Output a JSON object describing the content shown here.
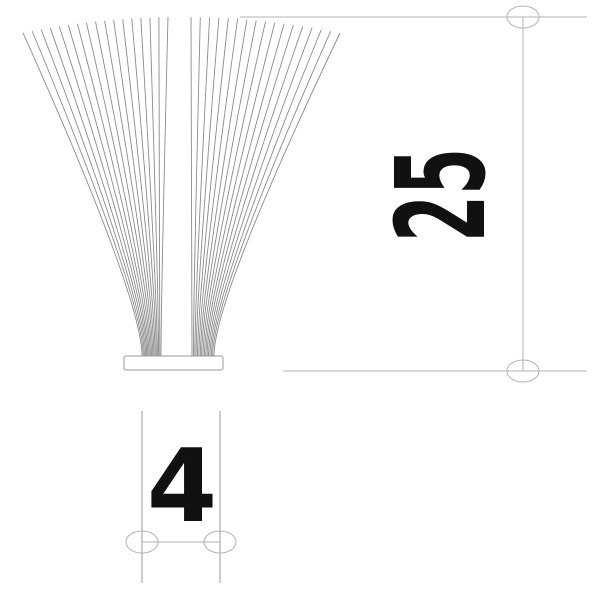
{
  "page": {
    "background": "#ffffff"
  },
  "drawing": {
    "type": "technical-drawing",
    "subject": "wire-brush-strip-profile",
    "text_color": "#111111",
    "wires": {
      "count_per_side": 17,
      "color": "#8a8a8a",
      "stroke_width": 0.9,
      "base_top_y": 356,
      "bend_y": 298,
      "tip_apex_y": 17,
      "tip_edge_y": 33,
      "apex_x": 181,
      "half_span": 159,
      "left": {
        "base_x_start": 142,
        "base_x_end": 161,
        "tip_x_start": 23,
        "tip_x_end": 168
      },
      "right": {
        "base_x_start": 192,
        "base_x_end": 214,
        "tip_x_start": 191,
        "tip_x_end": 340
      }
    },
    "base": {
      "x": 124,
      "y": 356,
      "width": 99,
      "height": 14,
      "stroke": "#999999",
      "fill": "#ffffff"
    },
    "dimensions": {
      "line_color": "#b3b3b3",
      "ext_line_color": "#9a9a9a",
      "marker_rx": 16,
      "marker_ry": 11,
      "height": {
        "label": "25",
        "line_x": 523,
        "top_y": 17,
        "bottom_y": 371,
        "ext_top_x1": 240,
        "ext_top_x2": 587,
        "ext_bottom_x1": 283,
        "ext_bottom_x2": 587,
        "text_x": 484,
        "text_y": 195,
        "font_size": 123,
        "condense": 0.55
      },
      "width": {
        "label": "4",
        "line_y": 542,
        "left_x": 142,
        "right_x": 220,
        "ext_y1": 411,
        "ext_y2": 583,
        "text_x": 182,
        "text_y": 521,
        "font_size": 101
      }
    }
  }
}
